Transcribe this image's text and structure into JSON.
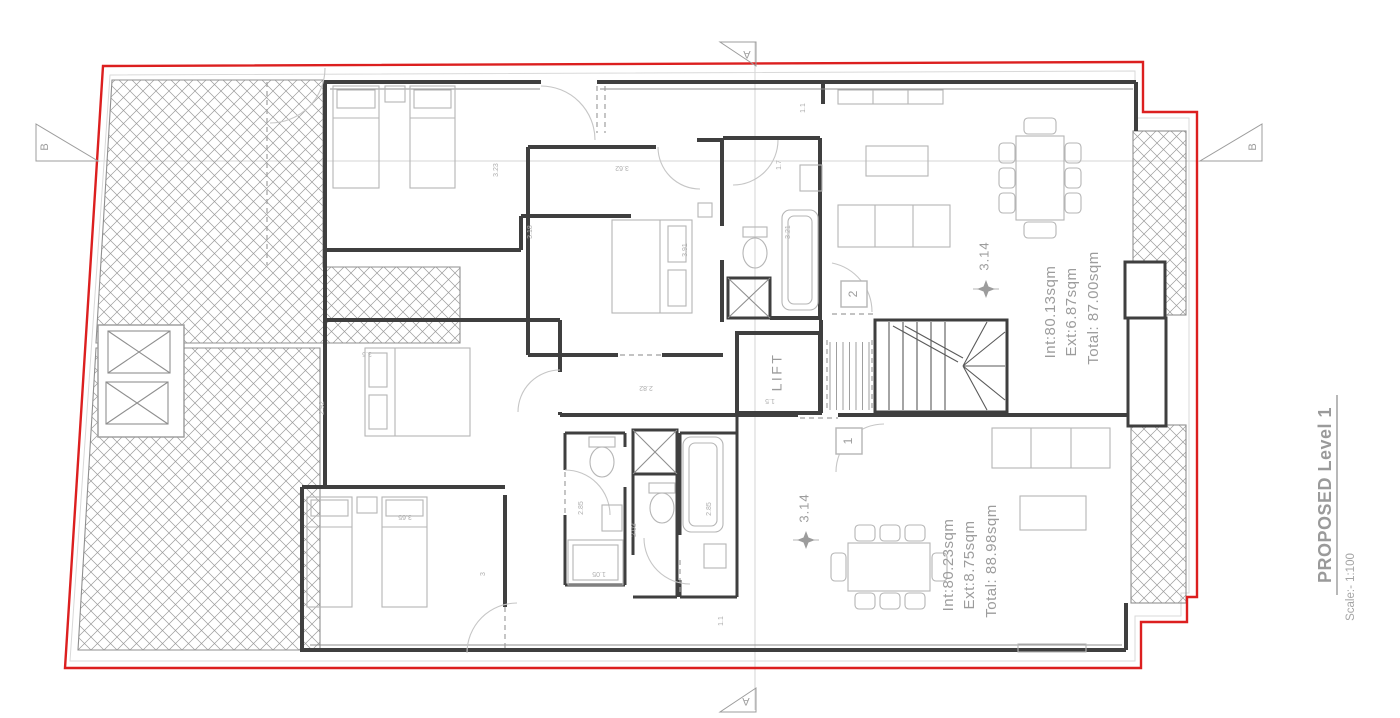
{
  "title_block": {
    "title": "PROPOSED Level 1",
    "scale": "Scale:- 1:100"
  },
  "section_markers": {
    "top": "A",
    "bottom": "A",
    "left": "B",
    "right": "B"
  },
  "core": {
    "lift_label": "LIFT"
  },
  "apartments": [
    {
      "badge": "2",
      "area_int": "Int:80.13sqm",
      "area_ext": "Ext:6.87sqm",
      "area_total": "Total: 87.00sqm",
      "spot_level": "3.14"
    },
    {
      "badge": "1",
      "area_int": "Int:80.23sqm",
      "area_ext": "Ext:8.75sqm",
      "area_total": "Total: 88.98sqm",
      "spot_level": "3.14"
    }
  ],
  "dimensions": [
    {
      "text": "3.5",
      "x": 367,
      "y": 354,
      "rot": 180
    },
    {
      "text": "3.23",
      "x": 496,
      "y": 170,
      "rot": -90
    },
    {
      "text": "3.18",
      "x": 530,
      "y": 232,
      "rot": -90
    },
    {
      "text": "3.62",
      "x": 622,
      "y": 168,
      "rot": 180
    },
    {
      "text": "3.91",
      "x": 685,
      "y": 250,
      "rot": -90
    },
    {
      "text": "2.82",
      "x": 646,
      "y": 388,
      "rot": 180
    },
    {
      "text": "1.7",
      "x": 779,
      "y": 165,
      "rot": -90
    },
    {
      "text": "1.1",
      "x": 803,
      "y": 108,
      "rot": -90
    },
    {
      "text": "3.21",
      "x": 788,
      "y": 232,
      "rot": -90
    },
    {
      "text": "2.85",
      "x": 581,
      "y": 508,
      "rot": -90
    },
    {
      "text": "1.05",
      "x": 599,
      "y": 574,
      "rot": 180
    },
    {
      "text": "2.03",
      "x": 634,
      "y": 530,
      "rot": -90
    },
    {
      "text": "2.85",
      "x": 709,
      "y": 509,
      "rot": -90
    },
    {
      "text": "2.92",
      "x": 322,
      "y": 408,
      "rot": -90
    },
    {
      "text": "3.65",
      "x": 405,
      "y": 517,
      "rot": 180
    },
    {
      "text": "3",
      "x": 483,
      "y": 574,
      "rot": -90
    },
    {
      "text": "1.1",
      "x": 721,
      "y": 621,
      "rot": -90
    },
    {
      "text": "1.5",
      "x": 770,
      "y": 401,
      "rot": 180
    }
  ],
  "colors": {
    "site_boundary": "#dc1f1f",
    "walls": "#3f3f3f",
    "annotations": "#9c9c9c",
    "dimensions": "#aeaeae",
    "furniture": "#b5b5b5",
    "hatch_lines": "#999999"
  }
}
